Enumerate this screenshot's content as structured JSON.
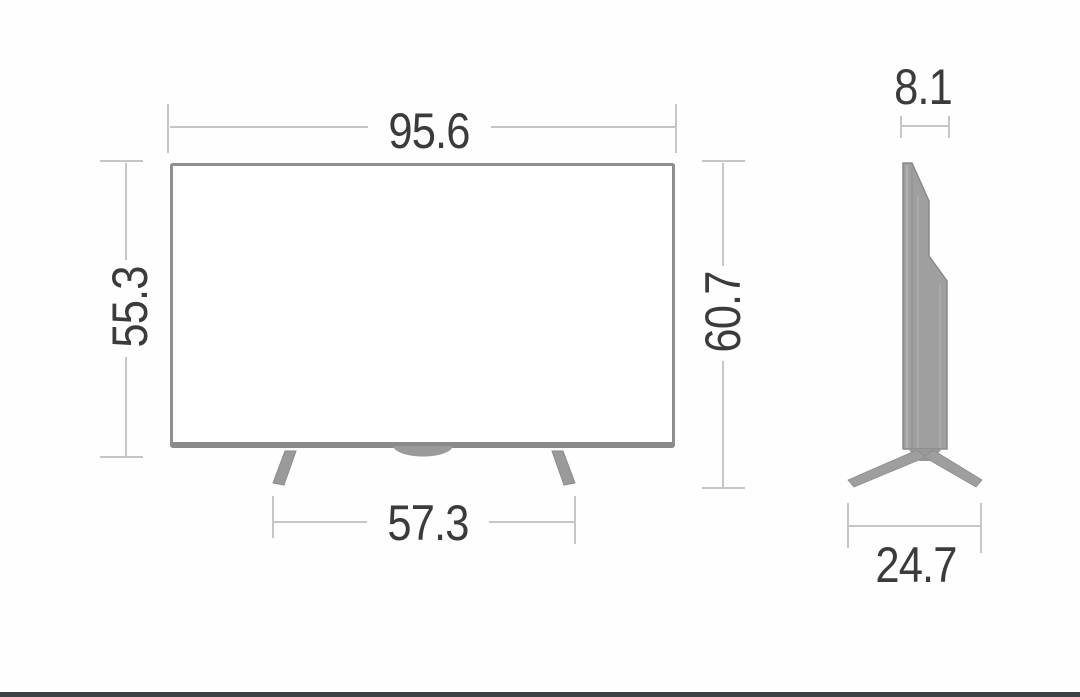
{
  "diagram": {
    "subject": "flat-screen television dimension drawing, front view and side view",
    "views": {
      "front": {
        "name": "front-view",
        "dimensions": {
          "width": "95.6",
          "panel_height": "55.3",
          "total_height": "60.7",
          "stand_width": "57.3"
        }
      },
      "side": {
        "name": "side-view",
        "dimensions": {
          "top_depth": "8.1",
          "base_depth": "24.7"
        }
      }
    },
    "colors": {
      "background": "#fefefe",
      "dimension_line": "#c6c6c6",
      "dimension_text": "#3b3b3b",
      "tv_outline": "#8e8e8e",
      "tv_screen_fill": "#ffffff",
      "stand_fill": "#9e9e9e",
      "footer_bar": "#3f4245"
    }
  }
}
